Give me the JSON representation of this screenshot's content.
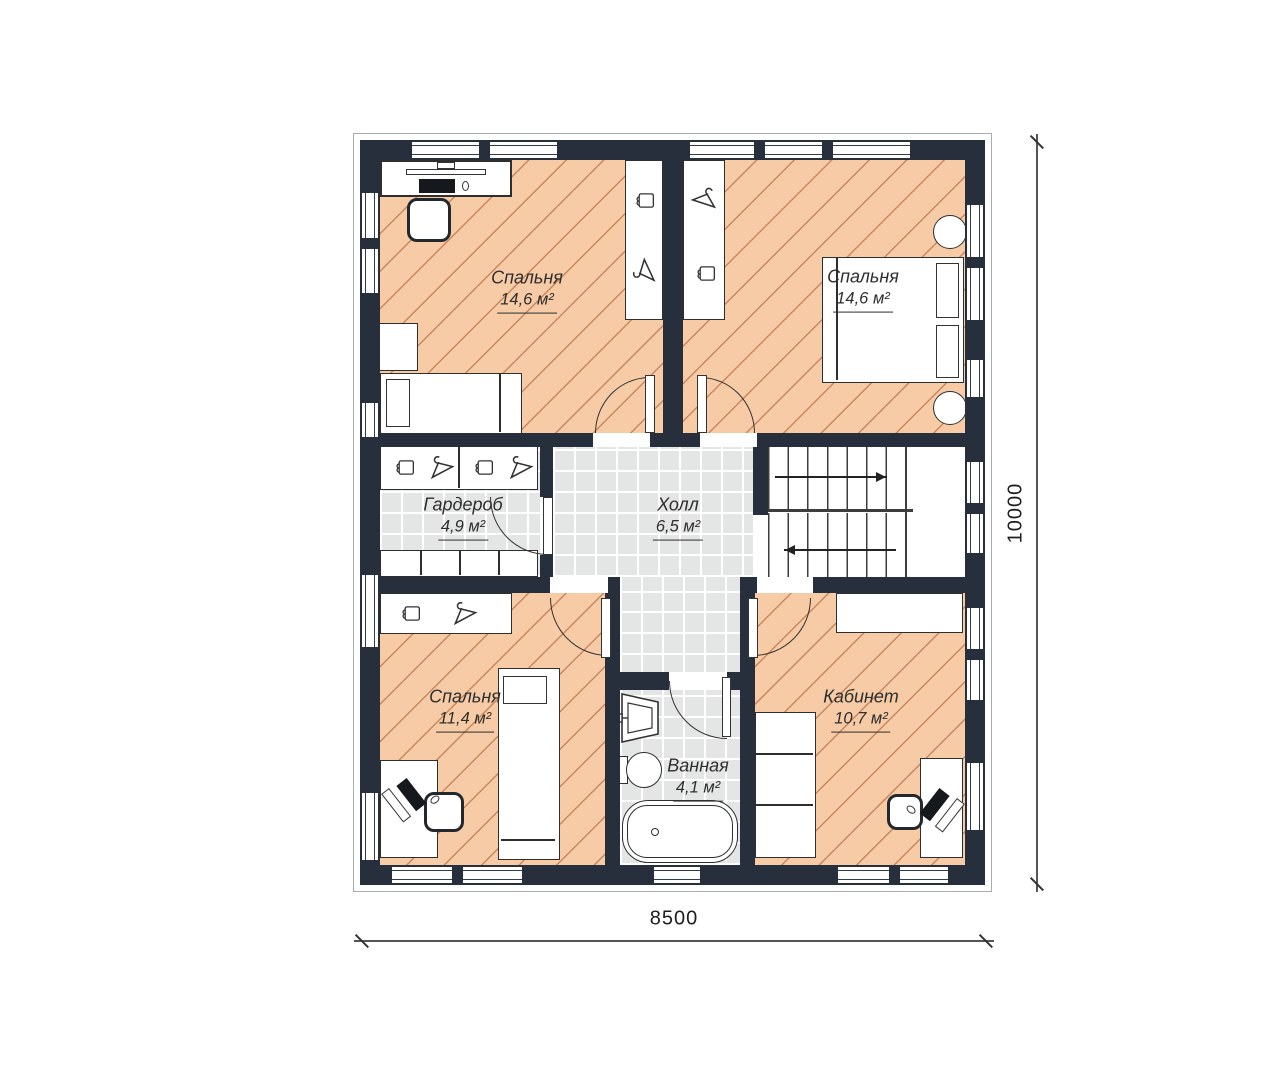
{
  "plan_title": "floor-plan-second-storey",
  "rooms": [
    {
      "name": "Спальня",
      "area": "14,6 м²"
    },
    {
      "name": "Спальня",
      "area": "14,6 м²"
    },
    {
      "name": "Гардероб",
      "area": "4,9 м²"
    },
    {
      "name": "Холл",
      "area": "6,5 м²"
    },
    {
      "name": "Спальня",
      "area": "11,4 м²"
    },
    {
      "name": "Ванная",
      "area": "4,1 м²"
    },
    {
      "name": "Кабинет",
      "area": "10,7 м²"
    }
  ],
  "dimensions": {
    "width_mm": "8500",
    "height_mm": "10000"
  },
  "icons": {
    "hanger": "hanger-icon",
    "folded_clothes": "folded-clothes-icon",
    "stairs_up": "arrow-right-icon",
    "stairs_down": "arrow-left-icon"
  },
  "colors": {
    "wall": "#272f3d",
    "floor_warm": "#f6cba6",
    "hatch_line": "#c9875f",
    "tile": "#e4e6e6"
  }
}
